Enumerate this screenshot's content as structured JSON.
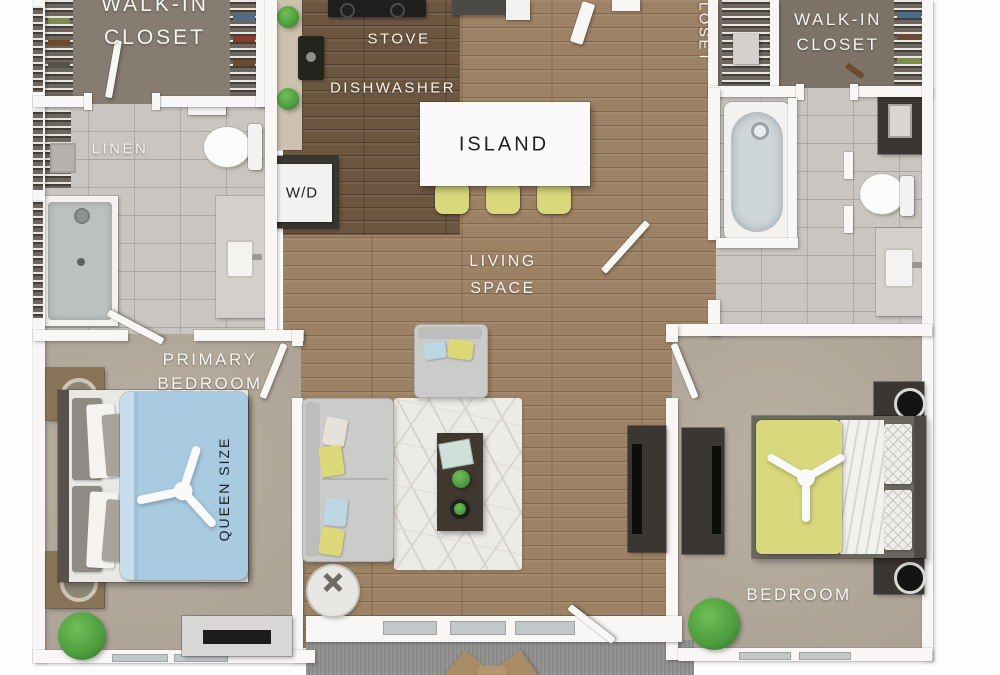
{
  "labels": {
    "walkin_left": {
      "line1": "WALK-IN",
      "line2": "CLOSET"
    },
    "linen": "LINEN",
    "stove": "STOVE",
    "dishwasher": "DISHWASHER",
    "island": "ISLAND",
    "washer_dryer": "W/D",
    "hall_closet": "CLOSET",
    "walkin_right": {
      "line1": "WALK-IN",
      "line2": "CLOSET"
    },
    "living": {
      "line1": "LIVING",
      "line2": "SPACE"
    },
    "primary": {
      "line1": "PRIMARY",
      "line2": "BEDROOM"
    },
    "queen_size": "QUEEN SIZE",
    "bedroom": "BEDROOM"
  },
  "colors": {
    "wall": "#f8f7f5",
    "wood": "#9d8265",
    "wood_dark": "#6d5640",
    "carpet": "#b4a99b",
    "tile": "#c9c5c0",
    "closet": "#867c71",
    "closet_dark": "#7d7368",
    "balcony": "#8f8f8d",
    "bed_blue": "#a9cbe2",
    "bed_yellow": "#d9d87c",
    "stool": "#d9d87c",
    "sofa": "#cbcbc9",
    "dark_furniture": "#3a3633",
    "plant": "#4d9c3e",
    "label_light": "#f6f4ef",
    "label_dark": "#1f1f1f"
  }
}
